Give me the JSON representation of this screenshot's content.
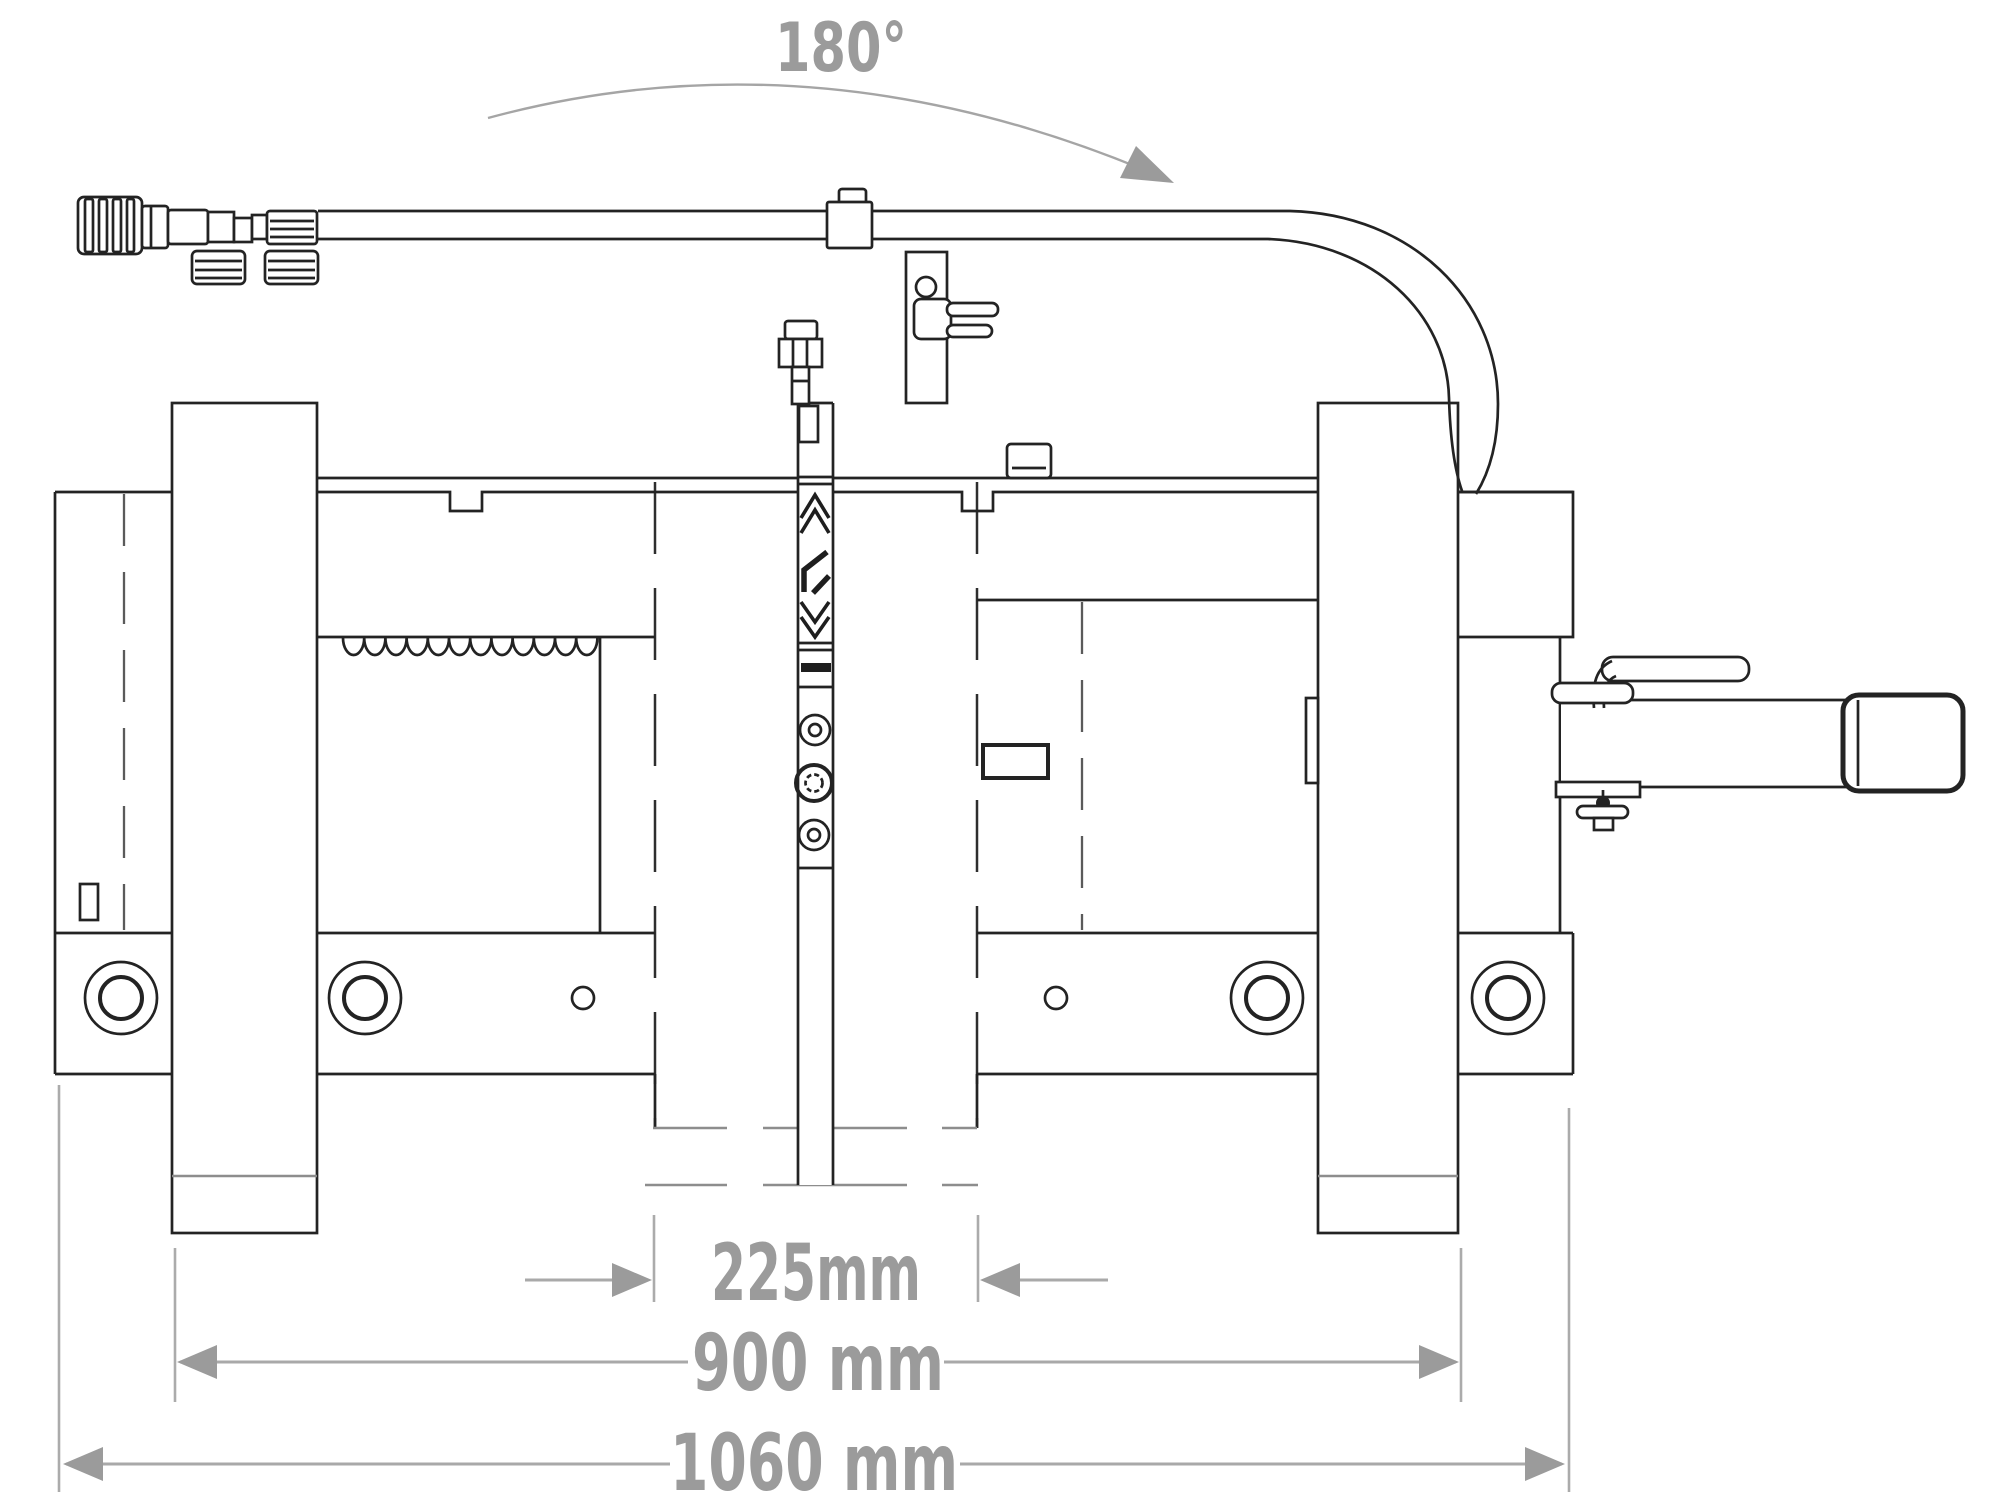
{
  "figure": {
    "type": "technical-drawing",
    "description": "Side elevation line drawing of a hydraulic implement with rotation and width dimensions",
    "background_color": "#ffffff",
    "line_color": "#232323",
    "annotation_color": "#9b9b9b",
    "rotation": {
      "label": "180°"
    },
    "dimension_labels": {
      "inner": "225mm",
      "posts": "900 mm",
      "overall": "1060 mm"
    }
  }
}
